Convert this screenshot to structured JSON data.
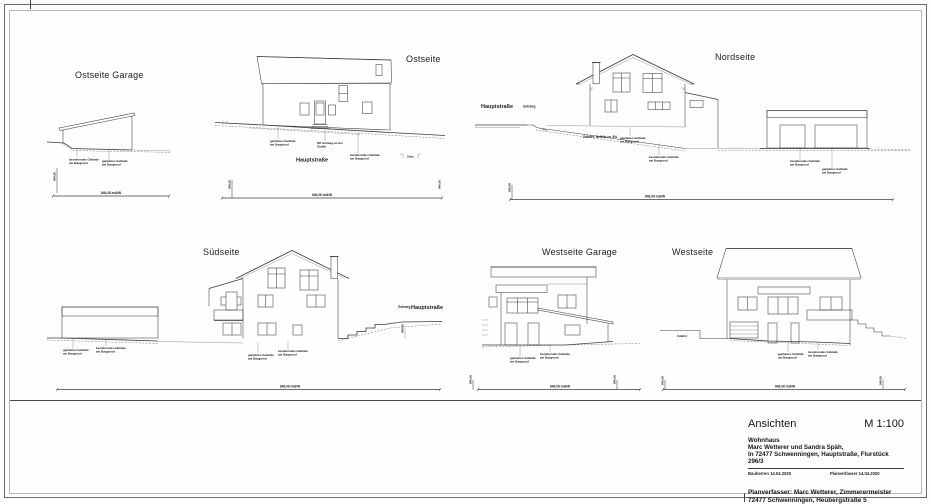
{
  "sheet": {
    "views": {
      "ost_garage": {
        "title": "Ostseite Garage"
      },
      "ost": {
        "title": "Ostseite",
        "street": "Hauptstraße"
      },
      "nord": {
        "title": "Nordseite",
        "street": "Hauptstraße",
        "sidewalk": "Gehweg",
        "driveway": "Zufahrt, Gefälle ca. 8%"
      },
      "sued": {
        "title": "Südseite",
        "street": "Hauptstraße",
        "sidewalk": "Gehweg"
      },
      "west_garage": {
        "title": "Westseite Garage"
      },
      "west": {
        "title": "Westseite",
        "driveway": "Zufahrt"
      }
    },
    "terrain": {
      "existing1": "bestehendes Gelände",
      "existing2": "am Baugrund",
      "planned1": "geplantes Gelände",
      "planned2": "am Baugrund",
      "curb1": "OK Gehweg an der",
      "curb2": "Straße",
      "fence": "Zaun",
      "datum": "846,08 müNN",
      "level": "846,08"
    },
    "title_block": {
      "doc_title": "Ansichten",
      "scale": "M 1:100",
      "building": "Wohnhaus",
      "client": "Marc Wetterer und Sandra Späh,",
      "location": "In 72477 Schwenningen, Hauptstraße, Flurstück 296/3",
      "sign_client": "Bauherren 14.04.2020",
      "sign_author": "Planverfasser 14.04.2020",
      "author": "Planverfasser: Marc Wetterer, Zimmerermeister",
      "author_address": "72477 Schwenningen, Heubergstraße 5"
    }
  }
}
